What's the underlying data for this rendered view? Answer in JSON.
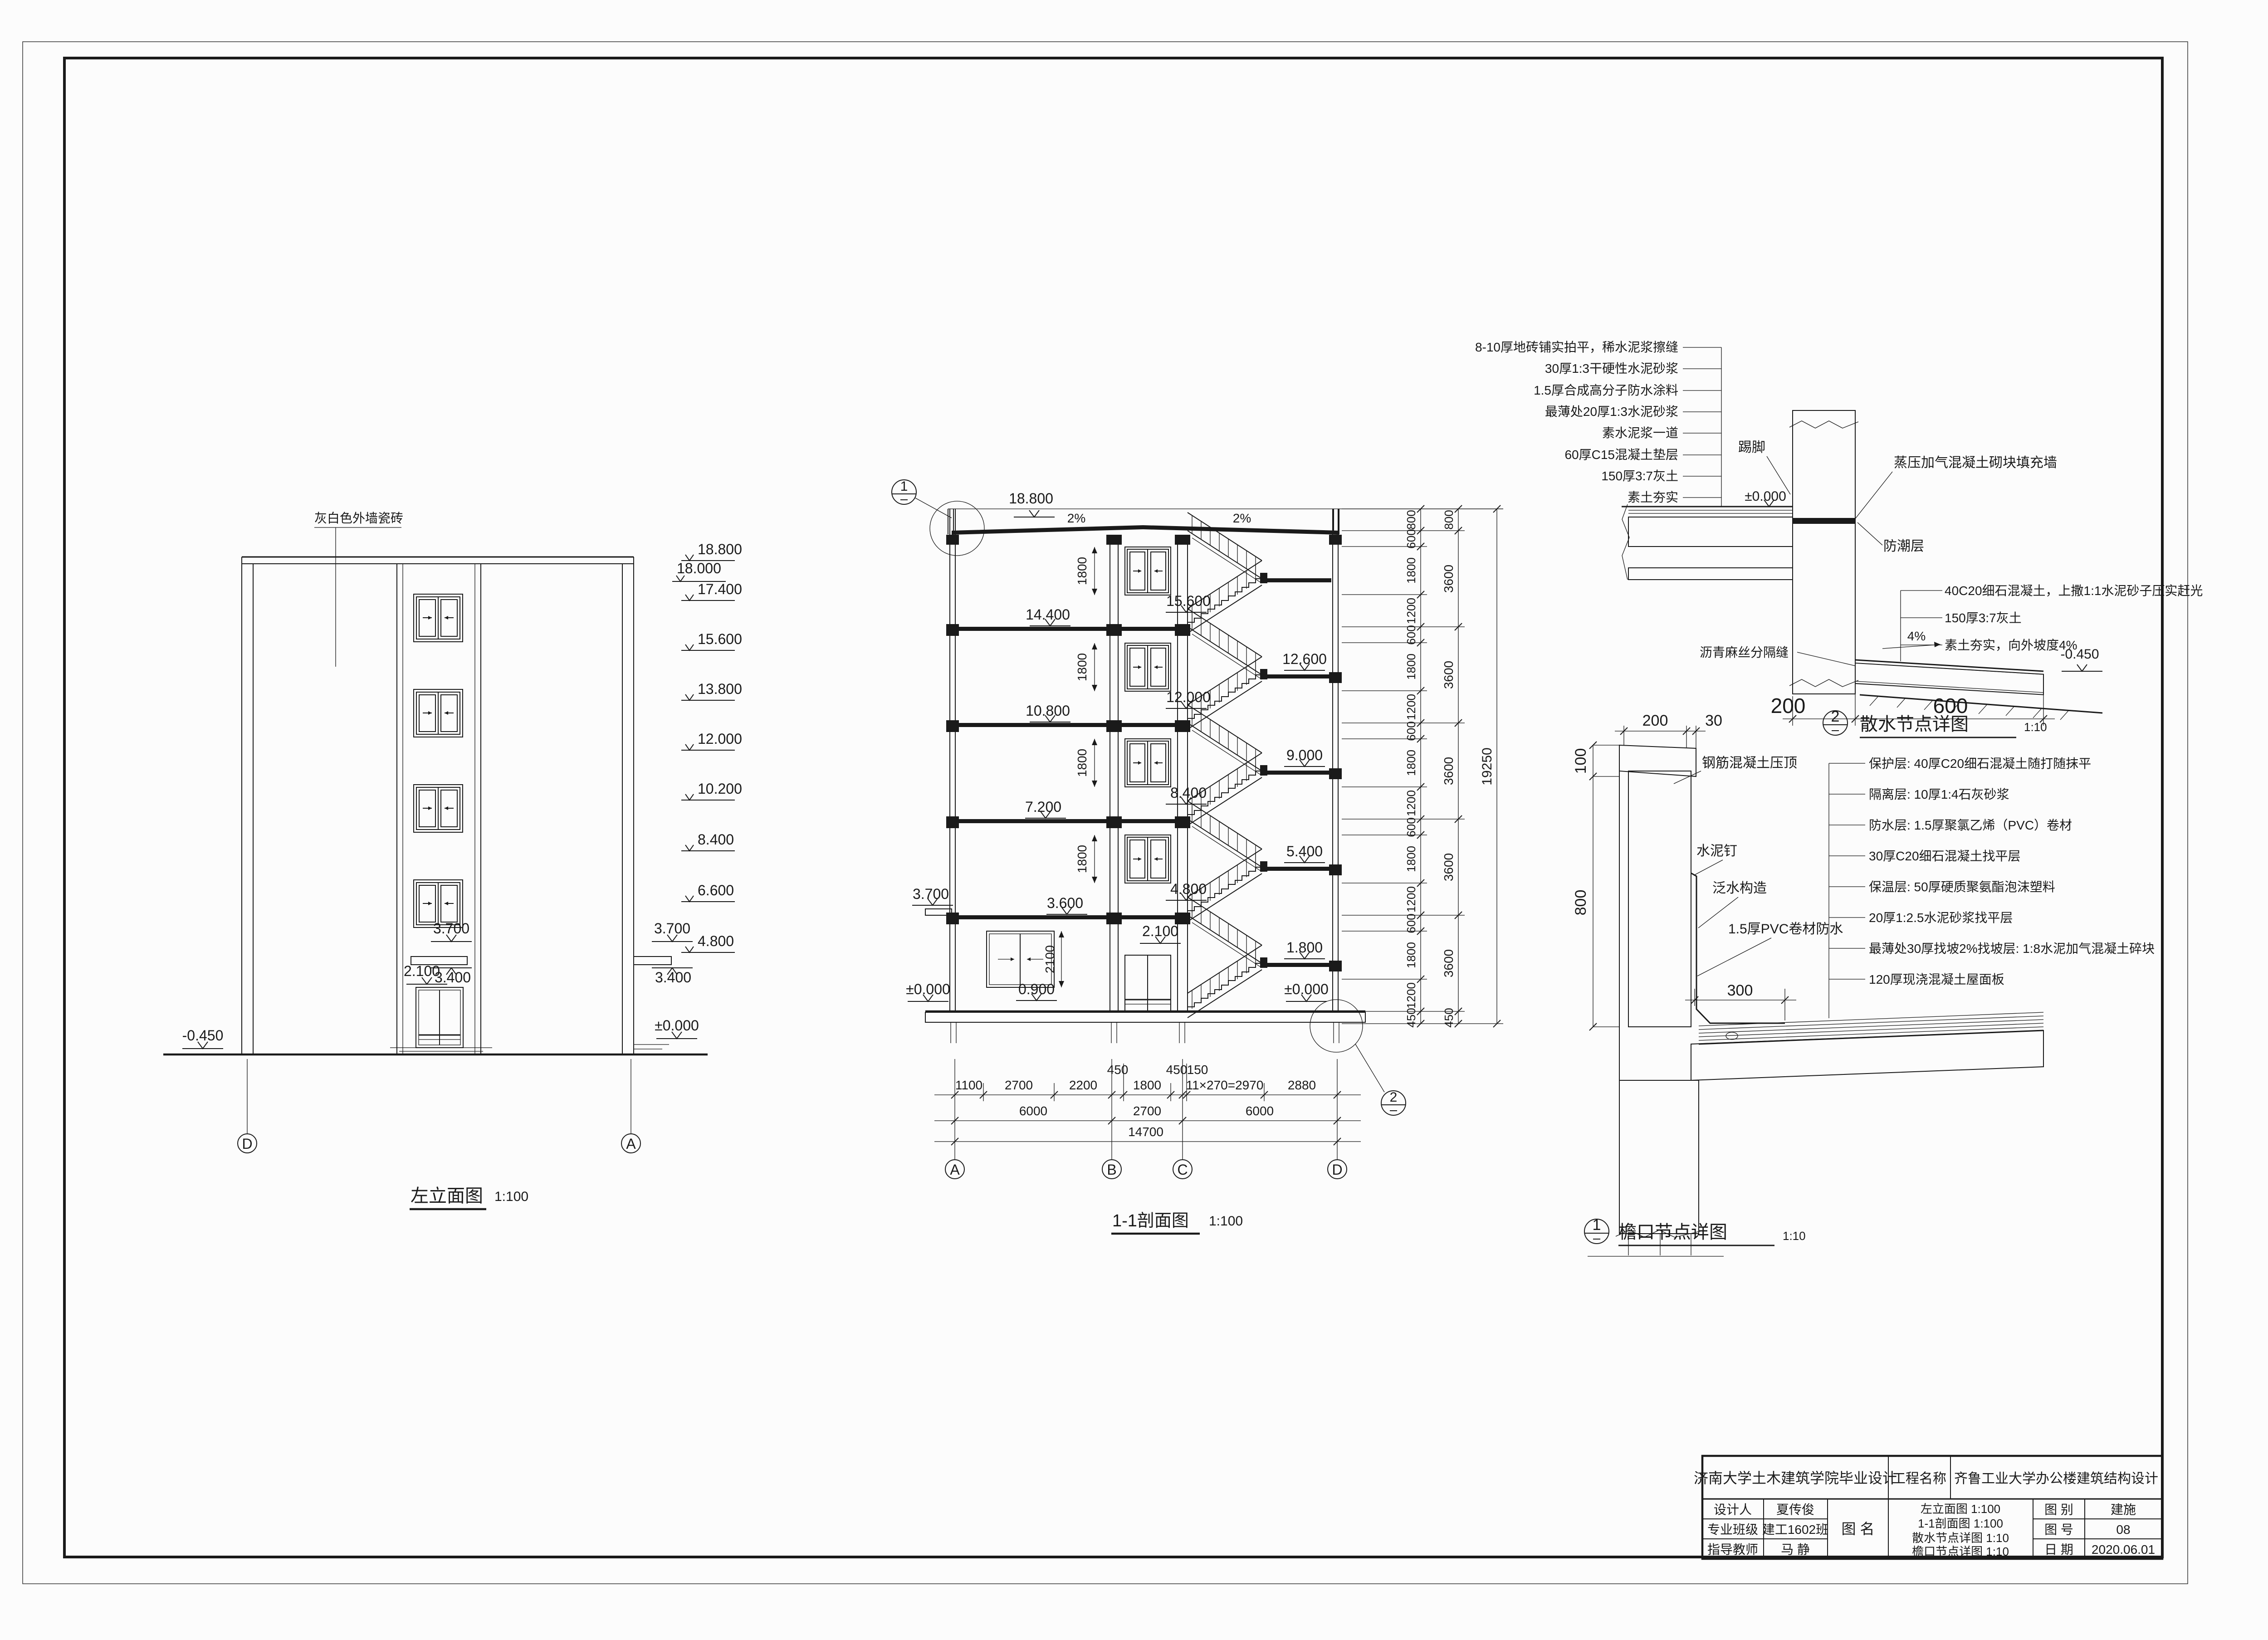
{
  "titleblock": {
    "school": "济南大学土木建筑学院毕业设计",
    "project_label": "工程名称",
    "project_name": "齐鲁工业大学办公楼建筑结构设计",
    "designer_label": "设计人",
    "designer": "夏传俊",
    "class_label": "专业班级",
    "class_value": "建工1602班",
    "advisor_label": "指导教师",
    "advisor": "马 静",
    "name_label": "图 名",
    "drawing_names": [
      "左立面图 1:100",
      "1-1剖面图 1:100",
      "散水节点详图 1:10",
      "檐口节点详图 1:10"
    ],
    "category_label": "图 别",
    "category": "建施",
    "no_label": "图 号",
    "no": "08",
    "date_label": "日 期",
    "date": "2020.06.01"
  },
  "elev": {
    "title": "左立面图",
    "scale": "1:100",
    "material": "灰白色外墙瓷砖",
    "top_level": "18.000",
    "levels": [
      "18.800",
      "17.400",
      "15.600",
      "13.800",
      "12.000",
      "10.200",
      "8.400",
      "6.600",
      "4.800"
    ],
    "canopy_top": "3.700",
    "canopy_bottom": "3.400",
    "door_head": "2.100",
    "zero": "±0.000",
    "minus": "-0.450",
    "axis_d": "D",
    "axis_a": "A"
  },
  "sec": {
    "title": "1-1剖面图",
    "scale": "1:100",
    "top": "18.800",
    "slope": "2%",
    "fl": [
      "14.400",
      "10.800",
      "7.200",
      "3.600"
    ],
    "canopy": "3.700",
    "mid": [
      "15.600",
      "12.000",
      "8.400",
      "4.800"
    ],
    "door": "2.100",
    "sill": "0.900",
    "land": [
      "12.600",
      "9.000",
      "5.400",
      "1.800"
    ],
    "zero": "±0.000",
    "winh": "1800",
    "gwinh": "2100",
    "s450": "450",
    "s150": "150",
    "r1": [
      "1100",
      "2700",
      "2200",
      "1800",
      "11×270=2970",
      "2880"
    ],
    "r2a": "6000",
    "r2b": "2700",
    "total": "14700",
    "axes": [
      "A",
      "B",
      "C",
      "D"
    ],
    "vp": "800",
    "va": "600",
    "vb": "1800",
    "vc": "1200",
    "vf": "3600",
    "vbase": "450",
    "vtotal": "19250"
  },
  "d2": {
    "ref": "2",
    "title": "散水节点详图",
    "scale": "1:10",
    "floor_layers": [
      "8-10厚地砖铺实拍平，稀水泥浆擦缝",
      "30厚1:3干硬性水泥砂浆",
      "1.5厚合成高分子防水涂料",
      "最薄处20厚1:3水泥砂浆",
      "素水泥浆一道",
      "60厚C15混凝土垫层",
      "150厚3:7灰土",
      "素土夯实"
    ],
    "zero": "±0.000",
    "minus": "-0.450",
    "skirt": "踢脚",
    "wall": "蒸压加气混凝土砌块填充墙",
    "damp": "防潮层",
    "apron": [
      "40C20细石混凝土，上撒1:1水泥砂子压实赶光",
      "150厚3:7灰土",
      "素土夯实，向外坡度4%"
    ],
    "slope": "4%",
    "joint": "沥青麻丝分隔缝",
    "d200": "200",
    "d600": "600"
  },
  "d1": {
    "ref": "1",
    "title": "檐口节点详图",
    "scale": "1:10",
    "d200": "200",
    "d30": "30",
    "d100": "100",
    "d800": "800",
    "d300": "300",
    "coping": "钢筋混凝土压顶",
    "nail": "水泥钉",
    "flash": "泛水构造",
    "pvc": "1.5厚PVC卷材防水",
    "layers": [
      "保护层: 40厚C20细石混凝土随打随抹平",
      "隔离层: 10厚1:4石灰砂浆",
      "防水层: 1.5厚聚氯乙烯（PVC）卷材",
      "30厚C20细石混凝土找平层",
      "保温层: 50厚硬质聚氨酯泡沫塑料",
      "20厚1:2.5水泥砂浆找平层",
      "最薄处30厚找坡2%找坡层: 1:8水泥加气混凝土碎块",
      "120厚现浇混凝土屋面板"
    ]
  }
}
